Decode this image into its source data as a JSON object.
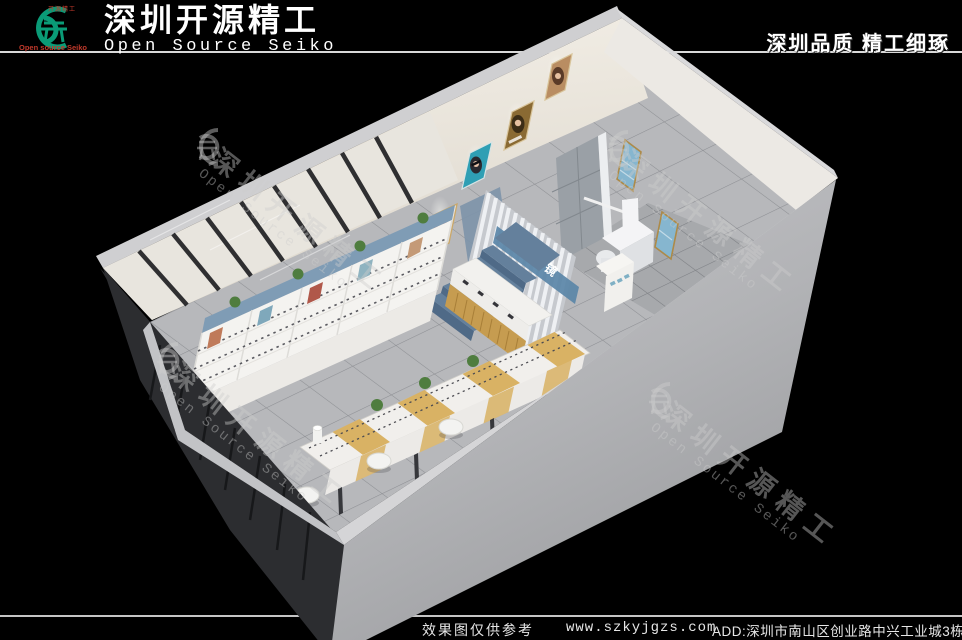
{
  "header": {
    "logo": {
      "top_text": "开源精工",
      "bottom_text": "Open source Seiko"
    },
    "title_cn": "深圳开源精工",
    "title_en": "Open Source Seiko",
    "slogan": "深圳品质 精工细琢"
  },
  "watermark": {
    "cn": "深圳开源精工",
    "en": "Open Source Seiko"
  },
  "scene": {
    "signage": "优视眼镜"
  },
  "footer": {
    "disclaimer": "效果图仅供参考",
    "website": "www.szkyjgzs.com",
    "address": "ADD:深圳市南山区创业路中兴工业城3栋"
  },
  "colors": {
    "logo_green": "#0a9b77",
    "logo_red": "#c0392b",
    "signage_band": "#5b87a8",
    "stairs_top": "#64809c",
    "stairs_front": "#4f6a87",
    "cabinet_band": "#7f9cb5",
    "counter_wood": "#c69c50",
    "island_wood": "#d9b264",
    "poster_teal": "#2f9fb4",
    "poster_gold": "#8a6a33",
    "poster_tan": "#b98d62",
    "exam_poster_blue": "#86b6cf",
    "plant_green": "#4f7d3f"
  }
}
